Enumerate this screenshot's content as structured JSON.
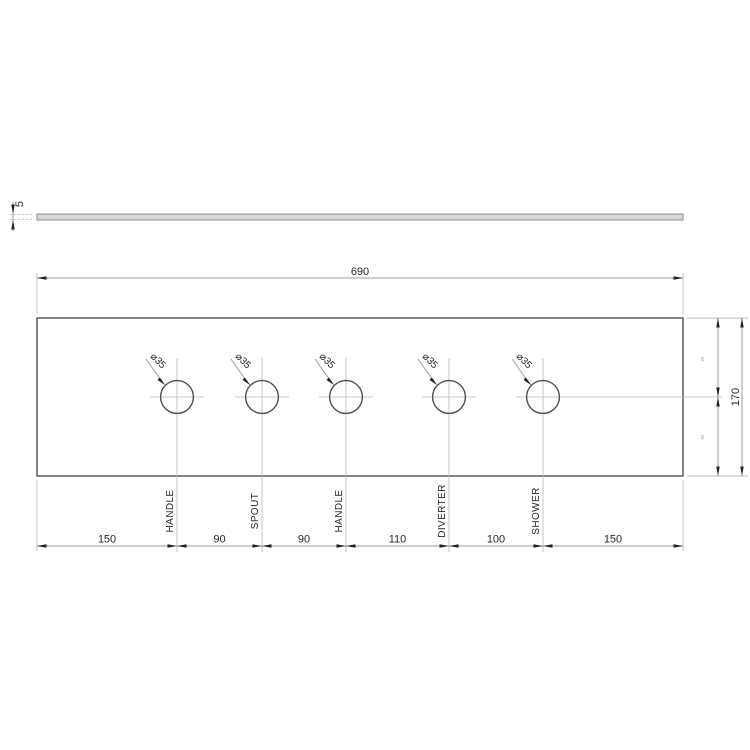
{
  "side_view": {
    "thickness_dim": "5"
  },
  "plan_view": {
    "width_dim": "690",
    "height_dim": "170",
    "half_height_dims": [
      "85",
      "85"
    ],
    "holes": [
      {
        "label": "HANDLE",
        "diameter": "⌀35"
      },
      {
        "label": "SPOUT",
        "diameter": "⌀35"
      },
      {
        "label": "HANDLE",
        "diameter": "⌀35"
      },
      {
        "label": "DIVERTER",
        "diameter": "⌀35"
      },
      {
        "label": "SHOWER",
        "diameter": "⌀35"
      }
    ],
    "spacing_dims": [
      "150",
      "90",
      "90",
      "110",
      "100",
      "150"
    ]
  },
  "colors": {
    "background": "#ffffff",
    "geometry": "#4f4f4f",
    "dimension_lines": "#9e9e9e",
    "centerlines": "#b6b6b6",
    "text": "#262626",
    "panel_fill": "#d8d8d8"
  }
}
